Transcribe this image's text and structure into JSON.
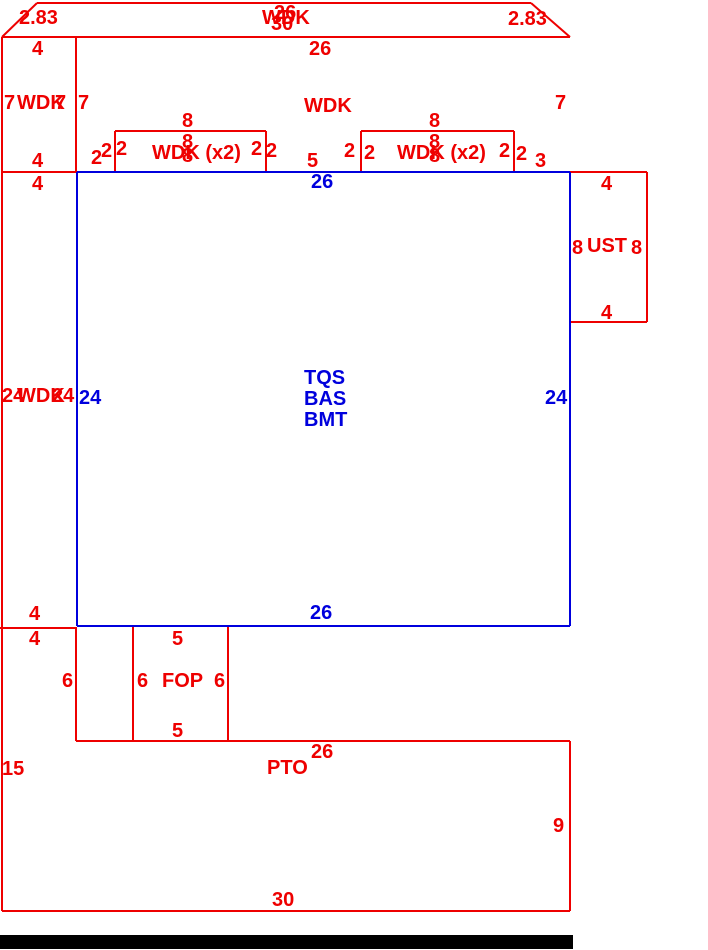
{
  "canvas": {
    "width": 708,
    "height": 950
  },
  "colors": {
    "red": "#ee0000",
    "blue": "#0000dd",
    "black": "#000000",
    "background": "#ffffff"
  },
  "footer_bar": {
    "x": 0,
    "y": 935,
    "width": 573,
    "height": 14
  },
  "lines": {
    "red": [
      [
        37,
        3,
        531,
        3
      ],
      [
        37,
        3,
        2,
        37
      ],
      [
        531,
        3,
        570,
        37
      ],
      [
        2,
        37,
        570,
        37
      ],
      [
        2,
        37,
        2,
        911
      ],
      [
        76,
        37,
        76,
        172
      ],
      [
        2,
        172,
        78,
        172
      ],
      [
        0,
        628,
        77,
        628
      ],
      [
        76,
        627,
        76,
        741
      ],
      [
        76,
        741,
        570,
        741
      ],
      [
        570,
        741,
        570,
        911
      ],
      [
        2,
        911,
        570,
        911
      ],
      [
        115,
        131,
        266,
        131
      ],
      [
        115,
        131,
        115,
        171
      ],
      [
        266,
        131,
        266,
        171
      ],
      [
        361,
        131,
        514,
        131
      ],
      [
        361,
        131,
        361,
        171
      ],
      [
        514,
        131,
        514,
        171
      ],
      [
        570,
        172,
        647,
        172
      ],
      [
        647,
        172,
        647,
        322
      ],
      [
        570,
        322,
        647,
        322
      ],
      [
        133,
        627,
        133,
        741
      ],
      [
        228,
        627,
        228,
        741
      ]
    ],
    "blue": [
      [
        77,
        172,
        570,
        172
      ],
      [
        77,
        172,
        77,
        626
      ],
      [
        570,
        172,
        570,
        626
      ],
      [
        77,
        626,
        570,
        626
      ]
    ]
  },
  "labels": [
    {
      "text": "2.83",
      "x": 19,
      "y": 8,
      "color": "red",
      "name": "dim-top-left-diagonal"
    },
    {
      "text": "26",
      "x": 274,
      "y": 3,
      "color": "red",
      "name": "dim-top-deck-upper-width"
    },
    {
      "text": "WDK",
      "x": 262,
      "y": 8,
      "color": "red",
      "name": "room-label-top-deck"
    },
    {
      "text": "30",
      "x": 271,
      "y": 14,
      "color": "red",
      "name": "dim-top-deck-lower-width"
    },
    {
      "text": "2.83",
      "x": 508,
      "y": 9,
      "color": "red",
      "name": "dim-top-right-diagonal"
    },
    {
      "text": "4",
      "x": 32,
      "y": 39,
      "color": "red",
      "name": "dim-left-strip-top"
    },
    {
      "text": "26",
      "x": 309,
      "y": 39,
      "color": "red",
      "name": "dim-upper-deck-width"
    },
    {
      "text": "7",
      "x": 4,
      "y": 93,
      "color": "red",
      "name": "dim-left-strip-left-height"
    },
    {
      "text": "WDK",
      "x": 17,
      "y": 93,
      "color": "red",
      "name": "room-label-left-strip-upper"
    },
    {
      "text": "7",
      "x": 55,
      "y": 93,
      "color": "red",
      "name": "dim-left-strip-right-height"
    },
    {
      "text": "7",
      "x": 78,
      "y": 93,
      "color": "red",
      "name": "dim-upper-deck-left-height"
    },
    {
      "text": "WDK",
      "x": 304,
      "y": 96,
      "color": "red",
      "name": "room-label-upper-deck"
    },
    {
      "text": "7",
      "x": 555,
      "y": 93,
      "color": "red",
      "name": "dim-upper-deck-right-height"
    },
    {
      "text": "8",
      "x": 182,
      "y": 111,
      "color": "red",
      "name": "dim-small-deck1-top-width"
    },
    {
      "text": "8",
      "x": 429,
      "y": 111,
      "color": "red",
      "name": "dim-small-deck2-top-width"
    },
    {
      "text": "2",
      "x": 91,
      "y": 148,
      "color": "red",
      "name": "dim-gap-left"
    },
    {
      "text": "2",
      "x": 101,
      "y": 141,
      "color": "red",
      "name": "dim-small-deck1-left-outer"
    },
    {
      "text": "2",
      "x": 116,
      "y": 139,
      "color": "red",
      "name": "dim-small-deck1-left-inner"
    },
    {
      "text": "WDK (x2)",
      "x": 152,
      "y": 143,
      "color": "red",
      "name": "room-label-small-deck1"
    },
    {
      "text": "8",
      "x": 182,
      "y": 132,
      "color": "red",
      "name": "dim-small-deck1-overlap-a"
    },
    {
      "text": "8",
      "x": 182,
      "y": 146,
      "color": "red",
      "name": "dim-small-deck1-overlap-b"
    },
    {
      "text": "2",
      "x": 251,
      "y": 139,
      "color": "red",
      "name": "dim-small-deck1-right-inner"
    },
    {
      "text": "2",
      "x": 266,
      "y": 141,
      "color": "red",
      "name": "dim-small-deck1-right-outer"
    },
    {
      "text": "5",
      "x": 307,
      "y": 151,
      "color": "red",
      "name": "dim-gap-middle"
    },
    {
      "text": "2",
      "x": 344,
      "y": 141,
      "color": "red",
      "name": "dim-small-deck2-left-outer"
    },
    {
      "text": "2",
      "x": 364,
      "y": 143,
      "color": "red",
      "name": "dim-small-deck2-left-inner"
    },
    {
      "text": "WDK (x2)",
      "x": 397,
      "y": 143,
      "color": "red",
      "name": "room-label-small-deck2"
    },
    {
      "text": "8",
      "x": 429,
      "y": 132,
      "color": "red",
      "name": "dim-small-deck2-overlap-a"
    },
    {
      "text": "8",
      "x": 429,
      "y": 146,
      "color": "red",
      "name": "dim-small-deck2-overlap-b"
    },
    {
      "text": "2",
      "x": 499,
      "y": 141,
      "color": "red",
      "name": "dim-small-deck2-right-inner"
    },
    {
      "text": "2",
      "x": 516,
      "y": 144,
      "color": "red",
      "name": "dim-small-deck2-right-outer"
    },
    {
      "text": "3",
      "x": 535,
      "y": 151,
      "color": "red",
      "name": "dim-gap-right"
    },
    {
      "text": "4",
      "x": 32,
      "y": 151,
      "color": "red",
      "name": "dim-left-strip-bottom"
    },
    {
      "text": "4",
      "x": 32,
      "y": 174,
      "color": "red",
      "name": "dim-left-strip2-top"
    },
    {
      "text": "4",
      "x": 601,
      "y": 174,
      "color": "red",
      "name": "dim-ust-top-width"
    },
    {
      "text": "8",
      "x": 572,
      "y": 238,
      "color": "red",
      "name": "dim-ust-left-height"
    },
    {
      "text": "UST",
      "x": 587,
      "y": 236,
      "color": "red",
      "name": "room-label-ust"
    },
    {
      "text": "8",
      "x": 631,
      "y": 238,
      "color": "red",
      "name": "dim-ust-right-height"
    },
    {
      "text": "4",
      "x": 601,
      "y": 303,
      "color": "red",
      "name": "dim-ust-bottom-width"
    },
    {
      "text": "24",
      "x": 2,
      "y": 386,
      "color": "red",
      "name": "dim-left-strip2-left-height"
    },
    {
      "text": "WDK",
      "x": 17,
      "y": 386,
      "color": "red",
      "name": "room-label-left-strip-lower"
    },
    {
      "text": "24",
      "x": 52,
      "y": 386,
      "color": "red",
      "name": "dim-left-strip2-right-height"
    },
    {
      "text": "4",
      "x": 29,
      "y": 604,
      "color": "red",
      "name": "dim-left-strip2-bottom"
    },
    {
      "text": "4",
      "x": 29,
      "y": 629,
      "color": "red",
      "name": "dim-patio-arm-top-width"
    },
    {
      "text": "5",
      "x": 172,
      "y": 629,
      "color": "red",
      "name": "dim-fop-top-width"
    },
    {
      "text": "6",
      "x": 62,
      "y": 671,
      "color": "red",
      "name": "dim-patio-arm-height"
    },
    {
      "text": "6",
      "x": 137,
      "y": 671,
      "color": "red",
      "name": "dim-fop-left-height"
    },
    {
      "text": "FOP",
      "x": 162,
      "y": 671,
      "color": "red",
      "name": "room-label-fop"
    },
    {
      "text": "6",
      "x": 214,
      "y": 671,
      "color": "red",
      "name": "dim-fop-right-height"
    },
    {
      "text": "5",
      "x": 172,
      "y": 721,
      "color": "red",
      "name": "dim-fop-bottom-width"
    },
    {
      "text": "26",
      "x": 311,
      "y": 742,
      "color": "red",
      "name": "dim-patio-top-width"
    },
    {
      "text": "PTO",
      "x": 267,
      "y": 758,
      "color": "red",
      "name": "room-label-pto"
    },
    {
      "text": "15",
      "x": 2,
      "y": 759,
      "color": "red",
      "name": "dim-patio-left-height"
    },
    {
      "text": "9",
      "x": 553,
      "y": 816,
      "color": "red",
      "name": "dim-patio-right-height"
    },
    {
      "text": "30",
      "x": 272,
      "y": 890,
      "color": "red",
      "name": "dim-patio-bottom-width"
    },
    {
      "text": "26",
      "x": 311,
      "y": 172,
      "color": "blue",
      "name": "dim-house-top-width"
    },
    {
      "text": "24",
      "x": 79,
      "y": 388,
      "color": "blue",
      "name": "dim-house-left-height"
    },
    {
      "text": "24",
      "x": 545,
      "y": 388,
      "color": "blue",
      "name": "dim-house-right-height"
    },
    {
      "text": "TQS",
      "x": 304,
      "y": 368,
      "color": "blue",
      "name": "room-label-tqs"
    },
    {
      "text": "BAS",
      "x": 304,
      "y": 389,
      "color": "blue",
      "name": "room-label-bas"
    },
    {
      "text": "BMT",
      "x": 304,
      "y": 410,
      "color": "blue",
      "name": "room-label-bmt"
    },
    {
      "text": "26",
      "x": 310,
      "y": 603,
      "color": "blue",
      "name": "dim-house-bottom-width"
    }
  ]
}
